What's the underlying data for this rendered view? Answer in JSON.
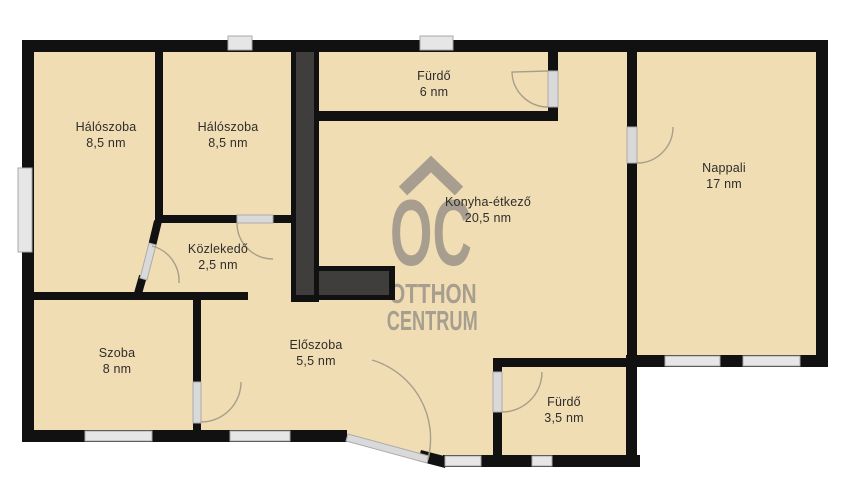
{
  "watermark": {
    "logo_letters": "OC",
    "line1": "OTTHON",
    "line2": "CENTRUM"
  },
  "rooms": [
    {
      "name": "Hálószoba",
      "area": "8,5 nm"
    },
    {
      "name": "Hálószoba",
      "area": "8,5 nm"
    },
    {
      "name": "Fürdő",
      "area": "6 nm"
    },
    {
      "name": "Nappali",
      "area": "17 nm"
    },
    {
      "name": "Konyha-étkező",
      "area": "20,5 nm"
    },
    {
      "name": "Közlekedő",
      "area": "2,5 nm"
    },
    {
      "name": "Szoba",
      "area": "8 nm"
    },
    {
      "name": "Előszoba",
      "area": "5,5 nm"
    },
    {
      "name": "Fürdő",
      "area": "3,5 nm"
    }
  ],
  "colors": {
    "floor": "#f0ddb4",
    "wall": "#111111",
    "shaft_fill": "#3f3e3c",
    "window": "#e6e6e6",
    "door_arc": "#a89f8a",
    "watermark": "#a79e8f",
    "label_text": "#2e2d2b",
    "background": "#ffffff"
  }
}
